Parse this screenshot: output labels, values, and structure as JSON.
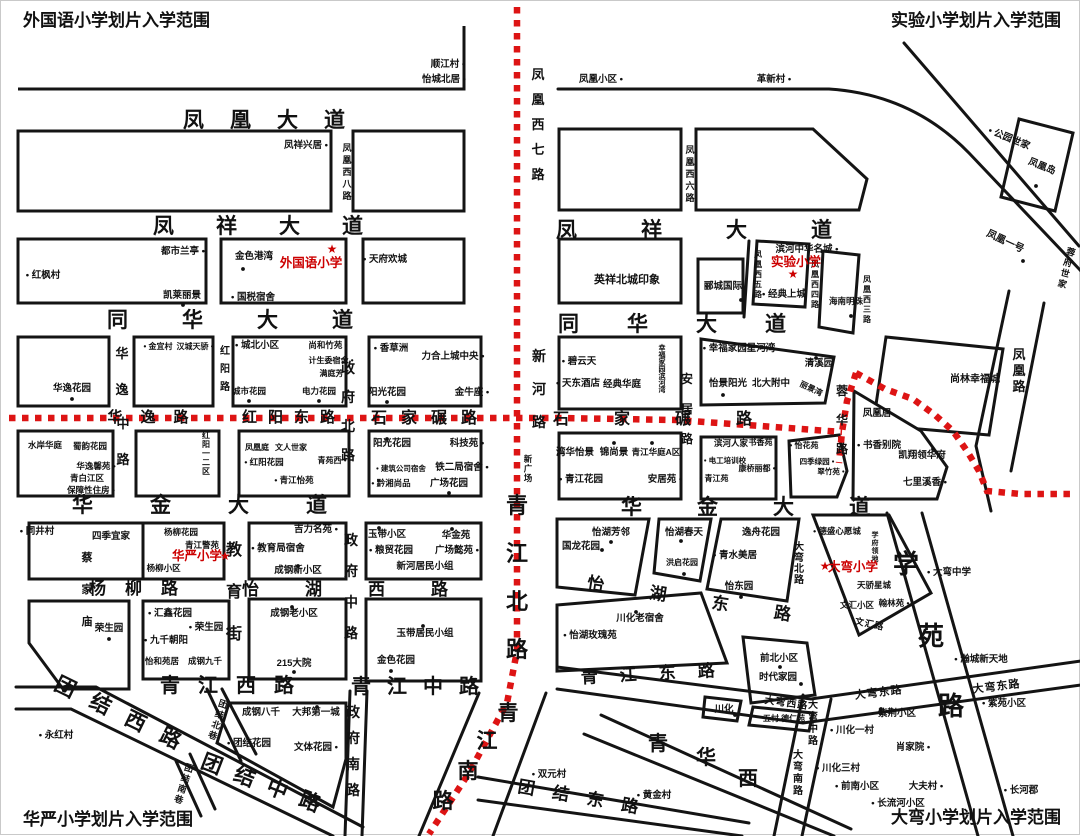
{
  "canvas": {
    "width": 1080,
    "height": 835,
    "background": "#ffffff"
  },
  "colors": {
    "ink": "#111111",
    "boundary": "#dd1414",
    "school_red": "#cc0000"
  },
  "titles": [
    {
      "t": "外国语小学划片入学范围",
      "x": 22,
      "y": 25,
      "anchor": "start"
    },
    {
      "t": "实验小学划片入学范围",
      "x": 1060,
      "y": 25,
      "anchor": "end"
    },
    {
      "t": "华严小学划片入学范围",
      "x": 22,
      "y": 824,
      "anchor": "start"
    },
    {
      "t": "大弯小学划片入学范围",
      "x": 1060,
      "y": 822,
      "anchor": "end"
    }
  ],
  "schools": [
    {
      "name": "外国语小学",
      "x": 310,
      "y": 266,
      "star": [
        331,
        252
      ]
    },
    {
      "name": "实验小学",
      "x": 795,
      "y": 265,
      "star": [
        792,
        277
      ]
    },
    {
      "name": "华严小学",
      "x": 196,
      "y": 559,
      "star": [
        224,
        559
      ]
    },
    {
      "name": "大弯小学",
      "x": 852,
      "y": 570,
      "star": [
        824,
        569
      ]
    }
  ],
  "roads": [
    {
      "t": "凤凰大道",
      "x": 276,
      "y": 126,
      "s": 21,
      "ls": 26
    },
    {
      "t": "凤祥大道",
      "x": 278,
      "y": 232,
      "s": 21,
      "ls": 42
    },
    {
      "t": "凤祥大道",
      "x": 725,
      "y": 236,
      "s": 21,
      "ls": 64
    },
    {
      "t": "同华大道",
      "x": 256,
      "y": 326,
      "s": 21,
      "ls": 54
    },
    {
      "t": "同华大道",
      "x": 695,
      "y": 330,
      "s": 21,
      "ls": 48
    },
    {
      "t": "华金大道",
      "x": 227,
      "y": 511,
      "s": 21,
      "ls": 57
    },
    {
      "t": "华金大道",
      "x": 772,
      "y": 513,
      "s": 21,
      "ls": 55
    },
    {
      "t": "青江西路",
      "x": 235,
      "y": 691,
      "s": 20,
      "ls": 18
    },
    {
      "t": "青江中路",
      "x": 422,
      "y": 692,
      "s": 20,
      "ls": 16
    },
    {
      "t": "青江东路",
      "x": 658,
      "y": 678,
      "s": 17,
      "ls": 22,
      "a": -3
    },
    {
      "t": "团结西路",
      "x": 122,
      "y": 722,
      "s": 21,
      "ls": 18,
      "a": 26
    },
    {
      "t": "团结中路",
      "x": 264,
      "y": 791,
      "s": 21,
      "ls": 14,
      "a": 21
    },
    {
      "t": "团结东路",
      "x": 585,
      "y": 803,
      "s": 17,
      "ls": 18,
      "a": 10
    },
    {
      "t": "华逸路",
      "x": 156,
      "y": 421,
      "s": 15,
      "ls": 18
    },
    {
      "t": "红阳东路",
      "x": 293,
      "y": 421,
      "s": 15,
      "ls": 11
    },
    {
      "t": "石家碾路",
      "x": 430,
      "y": 422,
      "s": 16,
      "ls": 14
    },
    {
      "t": "石家碾路",
      "x": 674,
      "y": 423,
      "s": 16,
      "ls": 45
    },
    {
      "t": "怡湖西路",
      "x": 367,
      "y": 594,
      "s": 17,
      "ls": 46
    },
    {
      "t": "怡湖东路",
      "x": 710,
      "y": 607,
      "s": 17,
      "ls": 46,
      "a": 9
    },
    {
      "t": "杨柳路",
      "x": 142,
      "y": 593,
      "s": 17,
      "ls": 19
    },
    {
      "t": "青江北路",
      "x": 516,
      "y": 512,
      "s": 22,
      "v": 1,
      "g": 26
    },
    {
      "t": "青江南路",
      "s": 21,
      "chars": [
        [
          507,
          719
        ],
        [
          486,
          747
        ],
        [
          467,
          777
        ],
        [
          442,
          807
        ]
      ]
    },
    {
      "t": "学苑路",
      "s": 26,
      "chars": [
        [
          905,
          572
        ],
        [
          930,
          644
        ],
        [
          950,
          714
        ]
      ]
    },
    {
      "t": "青华西",
      "s": 20,
      "chars": [
        [
          657,
          749
        ],
        [
          705,
          763
        ],
        [
          747,
          784
        ]
      ]
    },
    {
      "t": "凤凰西七路",
      "x": 537,
      "y": 78,
      "s": 13,
      "v": 1,
      "g": 12
    },
    {
      "t": "凤凰西八路",
      "x": 346,
      "y": 150,
      "s": 9,
      "v": 1,
      "g": 3
    },
    {
      "t": "凤凰西六路",
      "x": 689,
      "y": 152,
      "s": 9,
      "v": 1,
      "g": 3
    },
    {
      "t": "凤凰西五路",
      "x": 757,
      "y": 256,
      "s": 8,
      "v": 1,
      "g": 2
    },
    {
      "t": "凤凰西四路",
      "x": 814,
      "y": 266,
      "s": 8,
      "v": 1,
      "g": 2
    },
    {
      "t": "凤凰西三路",
      "x": 866,
      "y": 281,
      "s": 8,
      "v": 1,
      "g": 2
    },
    {
      "t": "新河路",
      "x": 538,
      "y": 360,
      "s": 14,
      "v": 1,
      "g": 19
    },
    {
      "t": "新广场",
      "x": 527,
      "y": 461,
      "s": 8.5,
      "v": 1,
      "g": 1
    },
    {
      "t": "安居路",
      "x": 686,
      "y": 382,
      "s": 12,
      "v": 1,
      "g": 18
    },
    {
      "t": "蓉华路",
      "x": 841,
      "y": 394,
      "s": 12,
      "v": 1,
      "g": 17
    },
    {
      "t": "红阳路",
      "x": 224,
      "y": 353,
      "s": 10,
      "v": 1,
      "g": 8
    },
    {
      "t": "华逸",
      "x": 121,
      "y": 357,
      "s": 13,
      "v": 1,
      "g": 23
    },
    {
      "t": "中路",
      "x": 122,
      "y": 427,
      "s": 13,
      "v": 1,
      "g": 23
    },
    {
      "t": "政府北路",
      "x": 347,
      "y": 372,
      "s": 14,
      "v": 1,
      "g": 15
    },
    {
      "t": "政府中路",
      "x": 350,
      "y": 544,
      "s": 14,
      "v": 1,
      "g": 17
    },
    {
      "t": "政府南路",
      "x": 352,
      "y": 716,
      "s": 14,
      "v": 1,
      "g": 12
    },
    {
      "t": "教育街",
      "x": 233,
      "y": 554,
      "s": 16,
      "v": 1,
      "g": 26
    },
    {
      "t": "凤凰路",
      "x": 1018,
      "y": 358,
      "s": 13,
      "v": 1,
      "g": 3
    },
    {
      "t": "大弯北路",
      "x": 798,
      "y": 549,
      "s": 10,
      "v": 1,
      "g": 1
    },
    {
      "t": "大弯中路",
      "x": 812,
      "y": 707,
      "s": 10,
      "v": 1,
      "g": 2
    },
    {
      "t": "大弯南路",
      "x": 797,
      "y": 757,
      "s": 10,
      "v": 1,
      "g": 2
    },
    {
      "t": "大弯西路",
      "x": 785,
      "y": 705,
      "s": 10,
      "ls": 1,
      "a": 8
    },
    {
      "t": "大弯东路",
      "x": 878,
      "y": 695,
      "s": 11,
      "ls": 1,
      "a": -7
    },
    {
      "t": "大弯东路",
      "x": 996,
      "y": 689,
      "s": 11,
      "ls": 1,
      "a": -7
    },
    {
      "t": "团结北巷",
      "x": 221,
      "y": 706,
      "s": 9,
      "v": 1,
      "g": 2,
      "a": 18
    },
    {
      "t": "团结南巷",
      "x": 187,
      "y": 770,
      "s": 9,
      "v": 1,
      "g": 2,
      "a": 18
    },
    {
      "t": "文汇路",
      "x": 868,
      "y": 626,
      "s": 9,
      "ls": 1,
      "a": 12
    }
  ],
  "places": [
    {
      "t": "顺江村 •",
      "x": 447,
      "y": 66
    },
    {
      "t": "怡城北居 •",
      "x": 443,
      "y": 81
    },
    {
      "t": "凤祥兴居 •",
      "x": 305,
      "y": 147
    },
    {
      "t": "都市兰亭 •",
      "x": 182,
      "y": 253
    },
    {
      "t": "• 红枫村",
      "x": 42,
      "y": 277
    },
    {
      "t": "凯莱丽景",
      "x": 181,
      "y": 297
    },
    {
      "t": "金色港湾",
      "x": 253,
      "y": 258
    },
    {
      "t": "• 国税宿舍",
      "x": 252,
      "y": 299
    },
    {
      "t": "• 天府欢城",
      "x": 384,
      "y": 261
    },
    {
      "t": "凤凰小区 •",
      "x": 600,
      "y": 81
    },
    {
      "t": "革新村 •",
      "x": 773,
      "y": 81
    },
    {
      "t": "• 公园世家",
      "x": 1007,
      "y": 140,
      "a": 22
    },
    {
      "t": "凤凰岛",
      "x": 1040,
      "y": 168,
      "a": 22
    },
    {
      "t": "凤凰一号",
      "x": 1003,
      "y": 243,
      "a": 25,
      "s": 10
    },
    {
      "t": "蓉府世家",
      "x": 1069,
      "y": 254,
      "v": 1,
      "s": 9,
      "g": 2,
      "a": 15
    },
    {
      "t": "英祥北城印象",
      "x": 626,
      "y": 282,
      "s": 11
    },
    {
      "t": "滨河中华名城 •",
      "x": 806,
      "y": 251
    },
    {
      "t": "郦城国际",
      "x": 722,
      "y": 288
    },
    {
      "t": "• 经典上城",
      "x": 783,
      "y": 296
    },
    {
      "t": "海南明珠",
      "x": 845,
      "y": 303,
      "s": 8.5
    },
    {
      "t": "尚林幸福城",
      "x": 974,
      "y": 381,
      "s": 10
    },
    {
      "t": "华逸花园",
      "x": 71,
      "y": 390
    },
    {
      "t": "• 金宜村",
      "x": 157,
      "y": 348,
      "s": 8
    },
    {
      "t": "汉城天骄 •",
      "x": 194,
      "y": 348,
      "s": 8
    },
    {
      "t": "• 城北小区",
      "x": 256,
      "y": 347
    },
    {
      "t": "尚和竹苑 •",
      "x": 327,
      "y": 347,
      "s": 8.5
    },
    {
      "t": "计生委宿舍 •",
      "x": 330,
      "y": 362,
      "s": 8
    },
    {
      "t": "满庭芳 •",
      "x": 333,
      "y": 375,
      "s": 8
    },
    {
      "t": "城市花园",
      "x": 248,
      "y": 393,
      "s": 8.5
    },
    {
      "t": "电力花园",
      "x": 318,
      "y": 393,
      "s": 8.5
    },
    {
      "t": "• 香草洲",
      "x": 390,
      "y": 350
    },
    {
      "t": "力合上城中央 •",
      "x": 452,
      "y": 358
    },
    {
      "t": "阳光花园",
      "x": 386,
      "y": 394
    },
    {
      "t": "金牛座 •",
      "x": 471,
      "y": 394
    },
    {
      "t": "水岸华庭",
      "x": 44,
      "y": 447,
      "s": 8.5
    },
    {
      "t": "蜀韵花园",
      "x": 89,
      "y": 448,
      "s": 8.5
    },
    {
      "t": "华逸馨苑 •",
      "x": 95,
      "y": 468,
      "s": 8.5
    },
    {
      "t": "青白江区",
      "x": 86,
      "y": 480,
      "s": 8.5
    },
    {
      "t": "保障性住房 •",
      "x": 90,
      "y": 492,
      "s": 8.5
    },
    {
      "t": "红阳一二区",
      "x": 205,
      "y": 437,
      "v": 1,
      "s": 8,
      "g": 1
    },
    {
      "t": "凤凰庭",
      "x": 256,
      "y": 449,
      "s": 8
    },
    {
      "t": "文人世家",
      "x": 290,
      "y": 449,
      "s": 8
    },
    {
      "t": "• 红阳花园",
      "x": 263,
      "y": 464,
      "s": 8.5
    },
    {
      "t": "青苑西 •",
      "x": 331,
      "y": 462,
      "s": 8
    },
    {
      "t": "• 青江怡苑",
      "x": 293,
      "y": 482,
      "s": 8.5
    },
    {
      "t": "阳光花园",
      "x": 391,
      "y": 445
    },
    {
      "t": "科技苑 •",
      "x": 466,
      "y": 445
    },
    {
      "t": "• 建筑公司宿舍",
      "x": 400,
      "y": 470,
      "s": 7.5
    },
    {
      "t": "铁二局宿舍 •",
      "x": 461,
      "y": 469
    },
    {
      "t": "• 黔湘尚品",
      "x": 390,
      "y": 485,
      "s": 8.5
    },
    {
      "t": "广场花园",
      "x": 448,
      "y": 485
    },
    {
      "t": "• 碧云天",
      "x": 578,
      "y": 363
    },
    {
      "t": "• 天东酒店",
      "x": 577,
      "y": 385
    },
    {
      "t": "经典华庭",
      "x": 621,
      "y": 386
    },
    {
      "t": "幸福家园滨河湾",
      "x": 661,
      "y": 349,
      "v": 1,
      "s": 7,
      "g": 0
    },
    {
      "t": "• 幸福家园星河湾",
      "x": 738,
      "y": 350
    },
    {
      "t": "怡景阳光",
      "x": 727,
      "y": 385
    },
    {
      "t": "北大附中",
      "x": 770,
      "y": 385
    },
    {
      "t": "清溪园",
      "x": 818,
      "y": 365
    },
    {
      "t": "丽景湾",
      "x": 809,
      "y": 390,
      "a": 25,
      "s": 8
    },
    {
      "t": "湾华怡景",
      "x": 574,
      "y": 454
    },
    {
      "t": "锦尚景",
      "x": 613,
      "y": 454
    },
    {
      "t": "青江华庭A区",
      "x": 655,
      "y": 454,
      "s": 8.5
    },
    {
      "t": "• 青江花园",
      "x": 580,
      "y": 481
    },
    {
      "t": "安居苑 •",
      "x": 664,
      "y": 481
    },
    {
      "t": "滨河人家",
      "x": 730,
      "y": 445,
      "s": 8.5
    },
    {
      "t": "书香苑 •",
      "x": 762,
      "y": 444,
      "s": 8
    },
    {
      "t": "• 电工培训校",
      "x": 724,
      "y": 462,
      "s": 7.5
    },
    {
      "t": "康桥丽都 •",
      "x": 756,
      "y": 470,
      "s": 8
    },
    {
      "t": "• 青江苑",
      "x": 713,
      "y": 480,
      "s": 8
    },
    {
      "t": "• 怡花苑",
      "x": 803,
      "y": 447,
      "s": 8
    },
    {
      "t": "四季绿园 •",
      "x": 816,
      "y": 463,
      "s": 7.5
    },
    {
      "t": "翠竹苑 •",
      "x": 830,
      "y": 473,
      "s": 7.5
    },
    {
      "t": "凤凰居",
      "x": 876,
      "y": 415
    },
    {
      "t": "• 书香别院",
      "x": 878,
      "y": 447
    },
    {
      "t": "凯翔领华府",
      "x": 921,
      "y": 457
    },
    {
      "t": "七里溪香 •",
      "x": 924,
      "y": 484
    },
    {
      "t": "四季宜家",
      "x": 110,
      "y": 538
    },
    {
      "t": "杨柳花园",
      "x": 180,
      "y": 534,
      "s": 8.5
    },
    {
      "t": "青江警苑",
      "x": 201,
      "y": 547,
      "s": 8.5
    },
    {
      "t": "• 杨柳小区",
      "x": 160,
      "y": 570,
      "s": 8.5
    },
    {
      "t": "吉力名苑 •",
      "x": 315,
      "y": 531
    },
    {
      "t": "• 教育局宿舍",
      "x": 277,
      "y": 550
    },
    {
      "t": "成钢新小区",
      "x": 297,
      "y": 572
    },
    {
      "t": "玉带小区",
      "x": 386,
      "y": 536
    },
    {
      "t": "华金苑",
      "x": 455,
      "y": 537
    },
    {
      "t": "• 粮贸花园",
      "x": 390,
      "y": 552
    },
    {
      "t": "广场懿苑 •",
      "x": 456,
      "y": 552
    },
    {
      "t": "新河居民小组",
      "x": 424,
      "y": 568
    },
    {
      "t": "怡湖芳邻",
      "x": 610,
      "y": 534
    },
    {
      "t": "国龙花园",
      "x": 580,
      "y": 548
    },
    {
      "t": "怡湖春天",
      "x": 683,
      "y": 534
    },
    {
      "t": "洪启花园",
      "x": 681,
      "y": 564,
      "s": 8
    },
    {
      "t": "逸舟花园",
      "x": 760,
      "y": 534
    },
    {
      "t": "• 青水美居",
      "x": 734,
      "y": 557
    },
    {
      "t": "怡东园",
      "x": 738,
      "y": 588
    },
    {
      "t": "• 德盛心愿城",
      "x": 836,
      "y": 533,
      "s": 8.5
    },
    {
      "t": "学府领地",
      "x": 874,
      "y": 536,
      "v": 1,
      "s": 7,
      "g": 1
    },
    {
      "t": "天骄星城",
      "x": 873,
      "y": 587,
      "s": 8.5
    },
    {
      "t": "文汇小区",
      "x": 856,
      "y": 607,
      "s": 8.5
    },
    {
      "t": "翰林苑 •",
      "x": 893,
      "y": 605,
      "s": 8.5
    },
    {
      "t": "• 大弯中学",
      "x": 948,
      "y": 574
    },
    {
      "t": "蔡家庙",
      "x": 86,
      "y": 560,
      "v": 1,
      "s": 11,
      "g": 21
    },
    {
      "t": "• 同井村",
      "x": 36,
      "y": 533
    },
    {
      "t": "荣生园",
      "x": 108,
      "y": 630
    },
    {
      "t": "• 汇鑫花园",
      "x": 169,
      "y": 615
    },
    {
      "t": "• 荣生园",
      "x": 205,
      "y": 629
    },
    {
      "t": "• 九千朝阳",
      "x": 165,
      "y": 642
    },
    {
      "t": "怡和苑居",
      "x": 161,
      "y": 663,
      "s": 8.5
    },
    {
      "t": "成钢九千",
      "x": 204,
      "y": 663,
      "s": 8.5
    },
    {
      "t": "成钢老小区",
      "x": 293,
      "y": 615
    },
    {
      "t": "215大院",
      "x": 293,
      "y": 665
    },
    {
      "t": "玉带居民小组",
      "x": 424,
      "y": 635
    },
    {
      "t": "金色花园",
      "x": 395,
      "y": 662
    },
    {
      "t": "川化老宿舍",
      "x": 639,
      "y": 620
    },
    {
      "t": "• 怡湖玫瑰苑",
      "x": 589,
      "y": 637
    },
    {
      "t": "• 永红村",
      "x": 55,
      "y": 737
    },
    {
      "t": "成钢八千",
      "x": 260,
      "y": 714
    },
    {
      "t": "大邦第一城",
      "x": 315,
      "y": 714
    },
    {
      "t": "• 团结花园",
      "x": 248,
      "y": 745
    },
    {
      "t": "文体花园 •",
      "x": 315,
      "y": 749
    },
    {
      "t": "• 双元村",
      "x": 548,
      "y": 776
    },
    {
      "t": "• 黄金村",
      "x": 653,
      "y": 797
    },
    {
      "t": "前北小区",
      "x": 778,
      "y": 660
    },
    {
      "t": "时代家园",
      "x": 777,
      "y": 679
    },
    {
      "t": "川化",
      "x": 723,
      "y": 711
    },
    {
      "t": "五村 德仁苑",
      "x": 783,
      "y": 720,
      "s": 8
    },
    {
      "t": "• 川化一村",
      "x": 851,
      "y": 732
    },
    {
      "t": "紫荆小区",
      "x": 896,
      "y": 715
    },
    {
      "t": "肖家院 •",
      "x": 912,
      "y": 749
    },
    {
      "t": "• 紫苑小区",
      "x": 1003,
      "y": 705
    },
    {
      "t": "• 川化三村",
      "x": 837,
      "y": 770
    },
    {
      "t": "• 前南小区",
      "x": 856,
      "y": 788
    },
    {
      "t": "大夫村 •",
      "x": 925,
      "y": 788
    },
    {
      "t": "• 长流河小区",
      "x": 897,
      "y": 805
    },
    {
      "t": "• 长河郡",
      "x": 1020,
      "y": 792
    },
    {
      "t": "• 瀚城新天地",
      "x": 980,
      "y": 661
    }
  ],
  "dots": [
    [
      182,
      304
    ],
    [
      242,
      268
    ],
    [
      71,
      398
    ],
    [
      386,
      401
    ],
    [
      248,
      400
    ],
    [
      318,
      400
    ],
    [
      386,
      438
    ],
    [
      448,
      492
    ],
    [
      613,
      442
    ],
    [
      651,
      442
    ],
    [
      815,
      357
    ],
    [
      722,
      394
    ],
    [
      610,
      541
    ],
    [
      601,
      549
    ],
    [
      680,
      540
    ],
    [
      683,
      573
    ],
    [
      740,
      596
    ],
    [
      635,
      611
    ],
    [
      297,
      565
    ],
    [
      378,
      527
    ],
    [
      451,
      528
    ],
    [
      422,
      625
    ],
    [
      390,
      670
    ],
    [
      291,
      606
    ],
    [
      293,
      671
    ],
    [
      108,
      638
    ],
    [
      316,
      706
    ],
    [
      779,
      666
    ],
    [
      800,
      683
    ],
    [
      734,
      714
    ],
    [
      880,
      708
    ],
    [
      932,
      448
    ],
    [
      1022,
      260
    ],
    [
      1035,
      185
    ],
    [
      740,
      299
    ],
    [
      850,
      315
    ]
  ]
}
